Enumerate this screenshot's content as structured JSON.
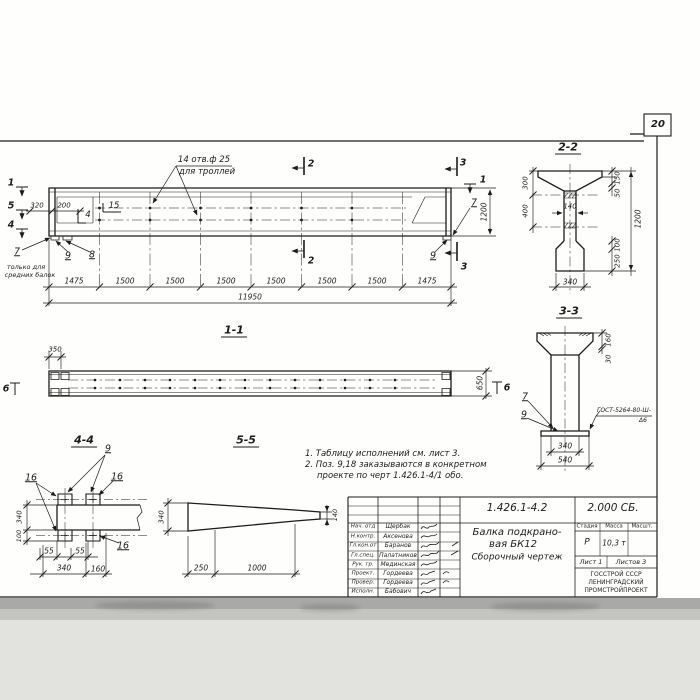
{
  "page": {
    "number": "20",
    "ink_color": "#1c1c1c",
    "paper_color": "#fefefd"
  },
  "elevation": {
    "hole_note_line1": "14 отв.ф 25",
    "hole_note_line2": "для троллей",
    "mark_1": "1",
    "mark_5": "5",
    "mark_4": "4",
    "mark_4b": "4",
    "mark_15": "15",
    "mark_2_top": "2",
    "mark_2_bot": "2",
    "mark_3_top": "3",
    "mark_3_bot": "3",
    "mark_1_right": "1",
    "pos_7_left": "7",
    "pos_9_left": "9",
    "pos_8_left": "8",
    "pos_7_right": "7",
    "pos_9_right": "9",
    "note7_line1": "только для",
    "note7_line2": "средних балок",
    "dim_320": "320",
    "dim_200": "200",
    "dim_1200": "1200",
    "segments": [
      "1475",
      "1500",
      "1500",
      "1500",
      "1500",
      "1500",
      "1500",
      "1475"
    ],
    "total": "11950"
  },
  "section22": {
    "title": "2-2",
    "d300": "300",
    "d400": "400",
    "d150": "150",
    "d50": "50",
    "d140": "140",
    "d1200": "1200",
    "d100": "100",
    "d250": "250",
    "d340": "340"
  },
  "section33": {
    "title": "3-3",
    "d160": "160",
    "d30": "30",
    "d340": "340",
    "d540": "540",
    "pos7": "7",
    "pos9": "9",
    "weld_note_line1": "ГОСТ-5264-80-Ш-",
    "weld_note_line2": "Δ6"
  },
  "view11": {
    "title": "1-1",
    "d350": "350",
    "d650": "650",
    "mark6_left": "6",
    "mark6_right": "6"
  },
  "section44": {
    "title": "4-4",
    "pos9": "9",
    "pos16_left": "16",
    "pos16_right": "16",
    "pos16_bottom": "16",
    "d340v": "340",
    "d100": "100",
    "d55a": "55",
    "d55b": "55",
    "d340b": "340",
    "d160": "160"
  },
  "section55": {
    "title": "5-5",
    "d340": "340",
    "d140": "140",
    "d250": "250",
    "d1000": "1000"
  },
  "notes": {
    "line1": "1. Таблицу исполнений см. лист 3.",
    "line2": "2. Поз. 9,18 заказываются в конкретном",
    "line3": "проекте по черт 1.426.1-4/1 обо."
  },
  "titleblock": {
    "doc_number": "1.426.1-4.2",
    "doc_code": "2.000 СБ.",
    "title_line1": "Балка подкрано-",
    "title_line2": "вая БК12",
    "title_line3": "Сборочный чертеж",
    "col_stage": "Стадия",
    "col_mass": "Масса",
    "col_scale": "Масшт.",
    "stage": "Р",
    "mass": "10,3 т",
    "sheet": "Лист 1",
    "sheets": "Листов 3",
    "org_line1": "ГОССТРОЙ СССР",
    "org_line2": "ЛЕНИНГРАДСКИЙ",
    "org_line3": "ПРОМСТРОЙПРОЕКТ",
    "rows": [
      {
        "role": "Нач. отд",
        "name": "Щербак"
      },
      {
        "role": "Н.контр.",
        "name": "Аксенова"
      },
      {
        "role": "Гл.кон.от",
        "name": "Баранов"
      },
      {
        "role": "Гл.спец.",
        "name": "Палатников"
      },
      {
        "role": "Рук. гр.",
        "name": "Мединская"
      },
      {
        "role": "Проект.",
        "name": "Гордеева"
      },
      {
        "role": "Провер.",
        "name": "Гордеева"
      },
      {
        "role": "Исполн.",
        "name": "Бабович"
      }
    ]
  }
}
